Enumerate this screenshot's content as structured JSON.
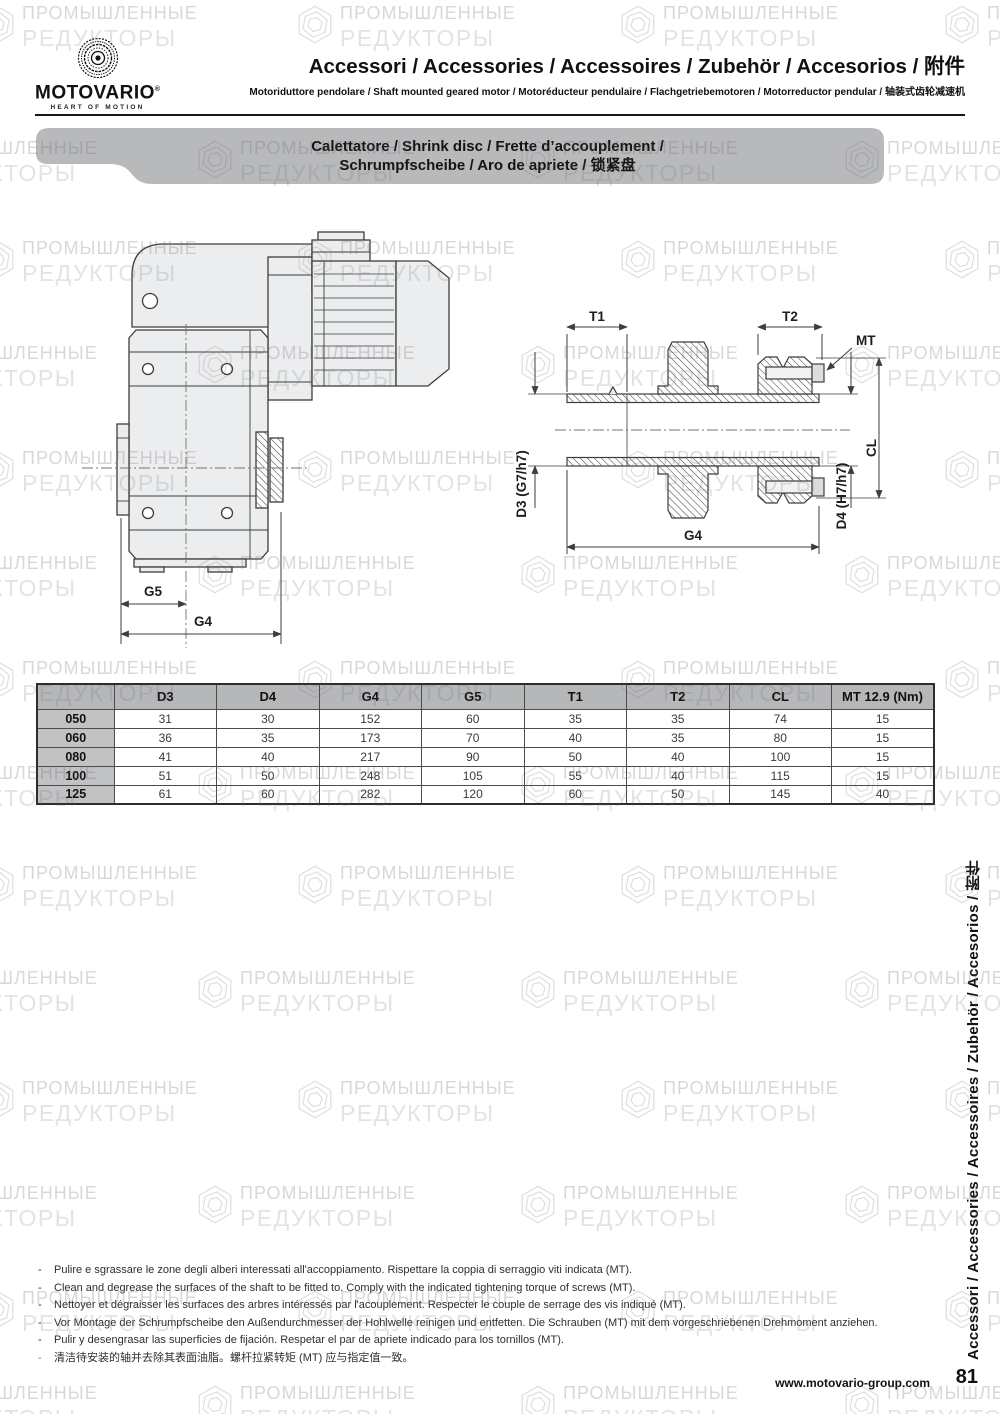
{
  "header": {
    "brand": "MOTOVARIO",
    "registered": "®",
    "tagline": "HEART OF MOTION",
    "title": "Accessori / Accessories / Accessoires / Zubehör / Accesorios / 附件",
    "subtitle": "Motoriduttore pendolare / Shaft mounted geared motor / Motoréducteur pendulaire / Flachgetriebemotoren / Motorreductor pendular / 轴装式齿轮减速机"
  },
  "banner": {
    "line1": "Calettatore / Shrink disc / Frette d’accouplement /",
    "line2": "Schrumpfscheibe / Aro de apriete / 锁紧盘"
  },
  "diagram": {
    "left_labels": {
      "g5": "G5",
      "g4": "G4"
    },
    "right_labels": {
      "t1": "T1",
      "t2": "T2",
      "mt": "MT",
      "cl": "CL",
      "d3": "D3 (G7/h7)",
      "d4": "D4 (H7/h7)",
      "g4": "G4"
    }
  },
  "table": {
    "columns": [
      "",
      "D3",
      "D4",
      "G4",
      "G5",
      "T1",
      "T2",
      "CL",
      "MT 12.9 (Nm)"
    ],
    "rows": [
      {
        "size": "050",
        "values": [
          "31",
          "30",
          "152",
          "60",
          "35",
          "35",
          "74",
          "15"
        ]
      },
      {
        "size": "060",
        "values": [
          "36",
          "35",
          "173",
          "70",
          "40",
          "35",
          "80",
          "15"
        ]
      },
      {
        "size": "080",
        "values": [
          "41",
          "40",
          "217",
          "90",
          "50",
          "40",
          "100",
          "15"
        ]
      },
      {
        "size": "100",
        "values": [
          "51",
          "50",
          "248",
          "105",
          "55",
          "40",
          "115",
          "15"
        ]
      },
      {
        "size": "125",
        "values": [
          "61",
          "60",
          "282",
          "120",
          "60",
          "50",
          "145",
          "40"
        ]
      }
    ]
  },
  "notes": [
    {
      "dash": "-",
      "dash_color": "#2e2e2e",
      "text": "Pulire e sgrassare le zone degli alberi interessati all'accoppiamento. Rispettare la coppia di serraggio viti indicata (MT)."
    },
    {
      "dash": "-",
      "dash_color": "#2e2e2e",
      "text": "Clean and degrease the surfaces of the shaft to be fitted to. Comply with the indicated tightening torque of screws (MT)."
    },
    {
      "dash": "-",
      "dash_color": "#2e2e2e",
      "text": "Nettoyer et dégraisser les surfaces des arbres intéressés par l'acouplement. Respecter le couple de serrage des vis indiqué (MT)."
    },
    {
      "dash": "-",
      "dash_color": "#2e2e2e",
      "text": "Vor Montage der Schrumpfscheibe den Außendurchmesser der Hohlwelle reinigen und entfetten. Die Schrauben (MT) mit dem vorgeschriebenen Drehmoment anziehen."
    },
    {
      "dash": "-",
      "dash_color": "#2e2e2e",
      "text": "Pulir y desengrasar las superficies de fijación. Respetar el par de apriete indicado para los tornillos (MT)."
    },
    {
      "dash": "-",
      "dash_color": "#d6545e",
      "text": "清洁待安装的轴并去除其表面油脂。螺杆拉紧转矩 (MT) 应与指定值一致。"
    }
  ],
  "sidebar": {
    "vertical_text": "Accessori / Accessories / Accessoires / Zubehör / Accesorios / 附件"
  },
  "footer": {
    "website": "www.motovario-group.com",
    "page_number": "81"
  },
  "watermark": {
    "line1": "ПРОМЫШЛЕННЫЕ",
    "line2": "РЕДУКТОРЫ"
  },
  "colors": {
    "banner_gray": "#b8b9bb",
    "table_header_gray": "#b6b7b9",
    "row_label_gray": "#c1c2c4",
    "note_dash_red": "#d6545e",
    "drawing_line": "#3d3d3d"
  }
}
